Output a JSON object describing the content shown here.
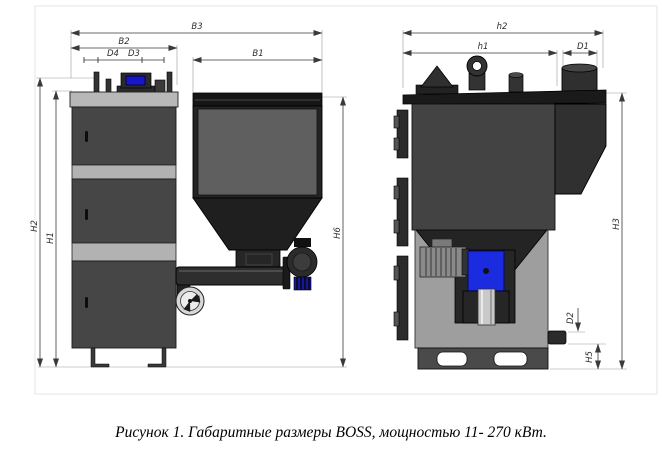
{
  "caption": "Рисунок 1. Габаритные размеры BOSS, мощностью 11- 270 кВт.",
  "front_view": {
    "dim_b3": "B3",
    "dim_b2": "B2",
    "dim_d4": "D4",
    "dim_d3": "D3",
    "dim_b1": "B1",
    "dim_h2": "H2",
    "dim_h1": "H1",
    "dim_h6": "H6"
  },
  "side_view": {
    "dim_h2": "h2",
    "dim_h1": "h1",
    "dim_d1": "D1",
    "dim_h3": "H3",
    "dim_d2": "D2",
    "dim_h5": "H5"
  },
  "colors": {
    "body_dark": "#434343",
    "hopper_dark": "#1f1f1f",
    "band_light": "#b4b4b4",
    "side_lower_gray": "#9e9e9e",
    "screen_blue": "#1717c8",
    "gearbox_blue": "#1b2be0",
    "dim_line": "#3a3a3a",
    "background": "#ffffff"
  }
}
